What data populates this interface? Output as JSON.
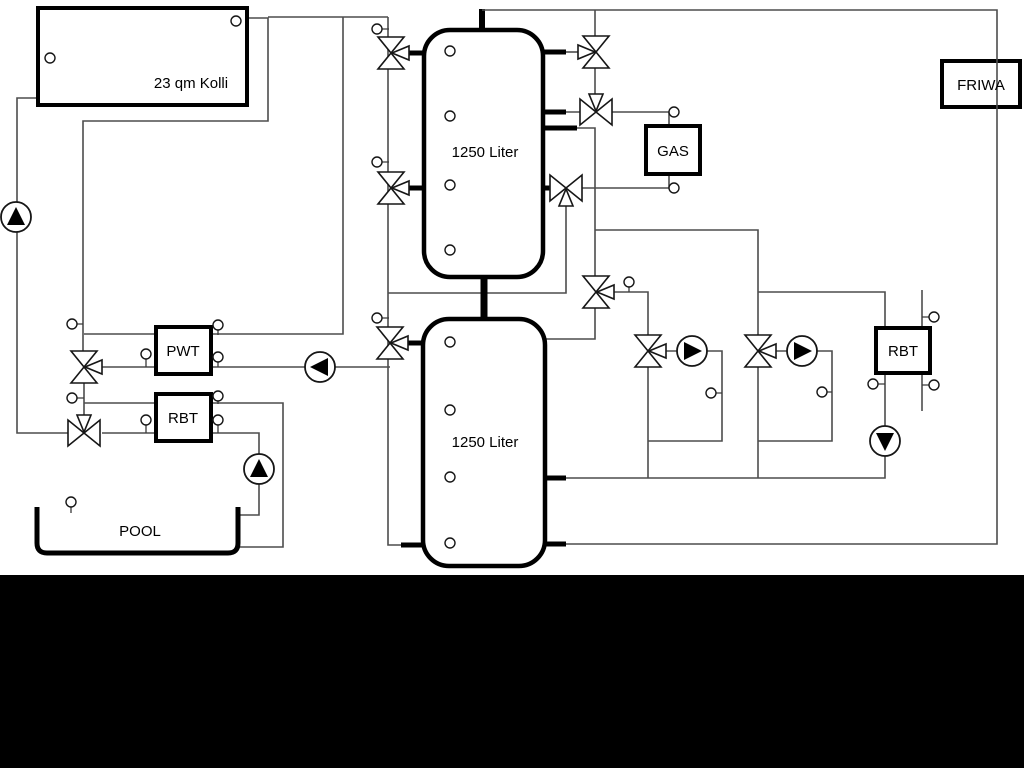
{
  "diagram": {
    "labels": {
      "collector": "23 qm Kolli",
      "tank_top": "1250 Liter",
      "tank_bottom": "1250 Liter",
      "pwt": "PWT",
      "rbt_pool": "RBT",
      "gas": "GAS",
      "rbt_heating": "RBT",
      "friwa": "FRIWA",
      "pool": "POOL"
    },
    "colors": {
      "background": "#ffffff",
      "pipe_line": "#4d4d4d",
      "component_outline": "#000000",
      "footer_bar": "#000000"
    },
    "components": {
      "tank_count": 2,
      "three_way_valve_count": 11,
      "pump_count": 6,
      "sensor_count": 30
    }
  }
}
